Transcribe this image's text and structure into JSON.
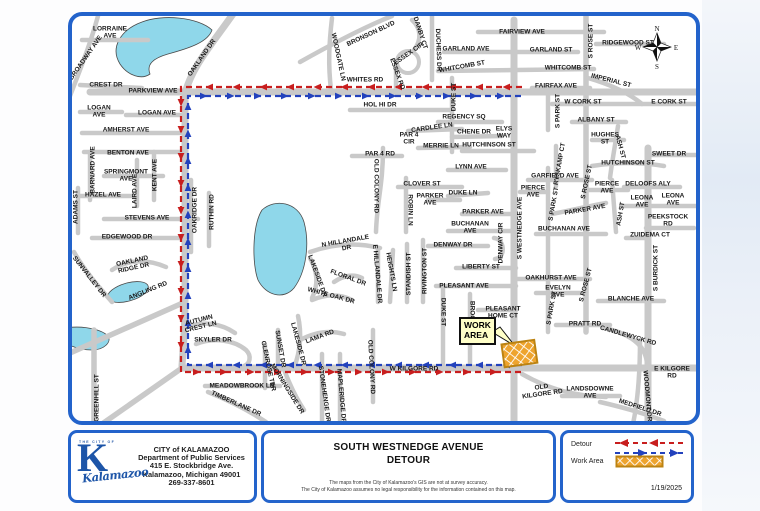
{
  "map": {
    "work_area_label": "WORK\nAREA",
    "compass": {
      "n": "N",
      "e": "E",
      "s": "S",
      "w": "W"
    },
    "routes": [
      {
        "name": "detour-red",
        "color": "#c81e1e",
        "points": [
          [
            522,
            87
          ],
          [
            181,
            87
          ],
          [
            181,
            372
          ],
          [
            522,
            372
          ]
        ]
      },
      {
        "name": "detour-blue",
        "color": "#2342bd",
        "points": [
          [
            522,
            365
          ],
          [
            188,
            365
          ],
          [
            188,
            96
          ],
          [
            522,
            96
          ]
        ]
      }
    ],
    "streets": [
      "LORRAINE\nAVE",
      "BROADWAY AVE",
      "OAKLAND DR",
      "CREST DR",
      "PARKVIEW AVE",
      "LOGAN\nAVE",
      "LOGAN AVE",
      "AMHERST AVE",
      "BENTON AVE",
      "BARNARD AVE",
      "SPRINGMONT\nAVE",
      "LAIRD AVE",
      "KENT AVE",
      "HAZEL AVE",
      "ADAMS ST",
      "STEVENS AVE",
      "OAKRIDGE DR",
      "RUTHIN RD",
      "EDGEWOOD DR",
      "OAKLAND\nRIDGE DR",
      "SUNVALLEY DR",
      "ANGLING RD",
      "GREENHILL ST",
      "AUTUMN\nCREST LN",
      "SKYLER DR",
      "MEADOWBROOK LN",
      "TIMBERLANE DR",
      "GLENROSE TER",
      "SUNSET DR",
      "MORNINGSIDE DR",
      "LAKESIDE DR",
      "LAMA RD",
      "STONEHENGE DR",
      "MAPLERIDGE DR",
      "OLD COLONY RD",
      "W KILGORE RD",
      "DUKE ST",
      "BROOK",
      "PLEASANT\nHOME CT",
      "PLEASANT AVE",
      "LIBERTY ST",
      "DENWAY DR",
      "DENWAY CIR",
      "S WESTNEDGE AVE",
      "BUCHANAN\nAVE",
      "PARKER\nAVE",
      "DUKE LN",
      "PARKER AVE",
      "CLOVER ST",
      "ROBIN LN",
      "LYNN AVE",
      "PAR 4 RD",
      "OLD COLONY RD",
      "N HILLANDALE\nDR",
      "E HILLANDALE DR",
      "HEIGHTS LN",
      "STANDISH ST",
      "RIVINGTON ST",
      "LAKESIDE DR",
      "FLORAL DR",
      "WHITE OAK DR",
      "BRONSON BLVD",
      "WOODGATE LN",
      "DANBY CT",
      "ESSEX CIR",
      "ESSEX RD",
      "DUCHESS DR",
      "GARLAND AVE",
      "WHITCOMB ST",
      "WHITES RD",
      "HOL HI DR",
      "DUKE ST",
      "REGENCY SQ",
      "CARDLEE LN",
      "CHENE DR",
      "ELYS\nWAY",
      "PAR 4\nCIR",
      "MERRIE LN",
      "HUTCHINSON ST",
      "FAIRVIEW AVE",
      "GARLAND ST",
      "S ROSE ST",
      "RIDGEWOOD ST",
      "WHITCOMB ST",
      "IMPERIAL ST",
      "FAIRFAX AVE",
      "W CORK ST",
      "E CORK ST",
      "S PARK ST",
      "ALBANY ST",
      "HUGHES\nST",
      "ASH ST",
      "SWEET DR",
      "RYSKAMP CT",
      "HUTCHINSON ST",
      "GARFIELD AVE",
      "S ROSE ST",
      "PIERCE\nAVE",
      "PIERCE\nAVE",
      "DELOOFS ALY",
      "LEONA\nAVE",
      "LEONA\nAVE",
      "S PARK ST",
      "PARKER AVE",
      "ASH ST",
      "PEEKSTOCK\nRD",
      "BUCHANAN AVE",
      "ZUIDEMA CT",
      "S BURDICK ST",
      "OAKHURST AVE",
      "EVELYN\nAVE",
      "S ROSE ST",
      "BLANCHE AVE",
      "S PARK ST",
      "PRATT RD",
      "CANDLEWYCK RD",
      "E KILGORE\nRD",
      "OLD\nKILGORE RD",
      "LANDSDOWNE\nAVE",
      "WOODMONT DR",
      "MEDFIELD DR"
    ]
  },
  "footer": {
    "agency": {
      "eyebrow": "THE CITY OF",
      "logo_letter": "K",
      "logo_script": "Kalamazoo",
      "line1": "CITY of KALAMAZOO",
      "line2": "Department of Public Services",
      "line3": "415 E. Stockbridge Ave.",
      "line4": "Kalamazoo, Michigan 49001",
      "line5": "269-337-8601"
    },
    "title_line1": "SOUTH WESTNEDGE AVENUE",
    "title_line2": "DETOUR",
    "disclaimer_line1": "The maps from the City of Kalamazoo's GIS are not at survey accuracy.",
    "disclaimer_line2": "The City of Kalamazoo assumes no legal responsibility for the information contained on this map.",
    "legend": {
      "detour": "Detour",
      "work_area": "Work Area"
    },
    "date": "1/19/2025"
  },
  "colors": {
    "frame_blue": "#2363cb",
    "detour_red": "#c81e1e",
    "detour_blue": "#2342bd",
    "work_area_orange": "#eea42e",
    "road_gray": "#c9c9c9",
    "lake_blue": "#8fd7ea"
  }
}
